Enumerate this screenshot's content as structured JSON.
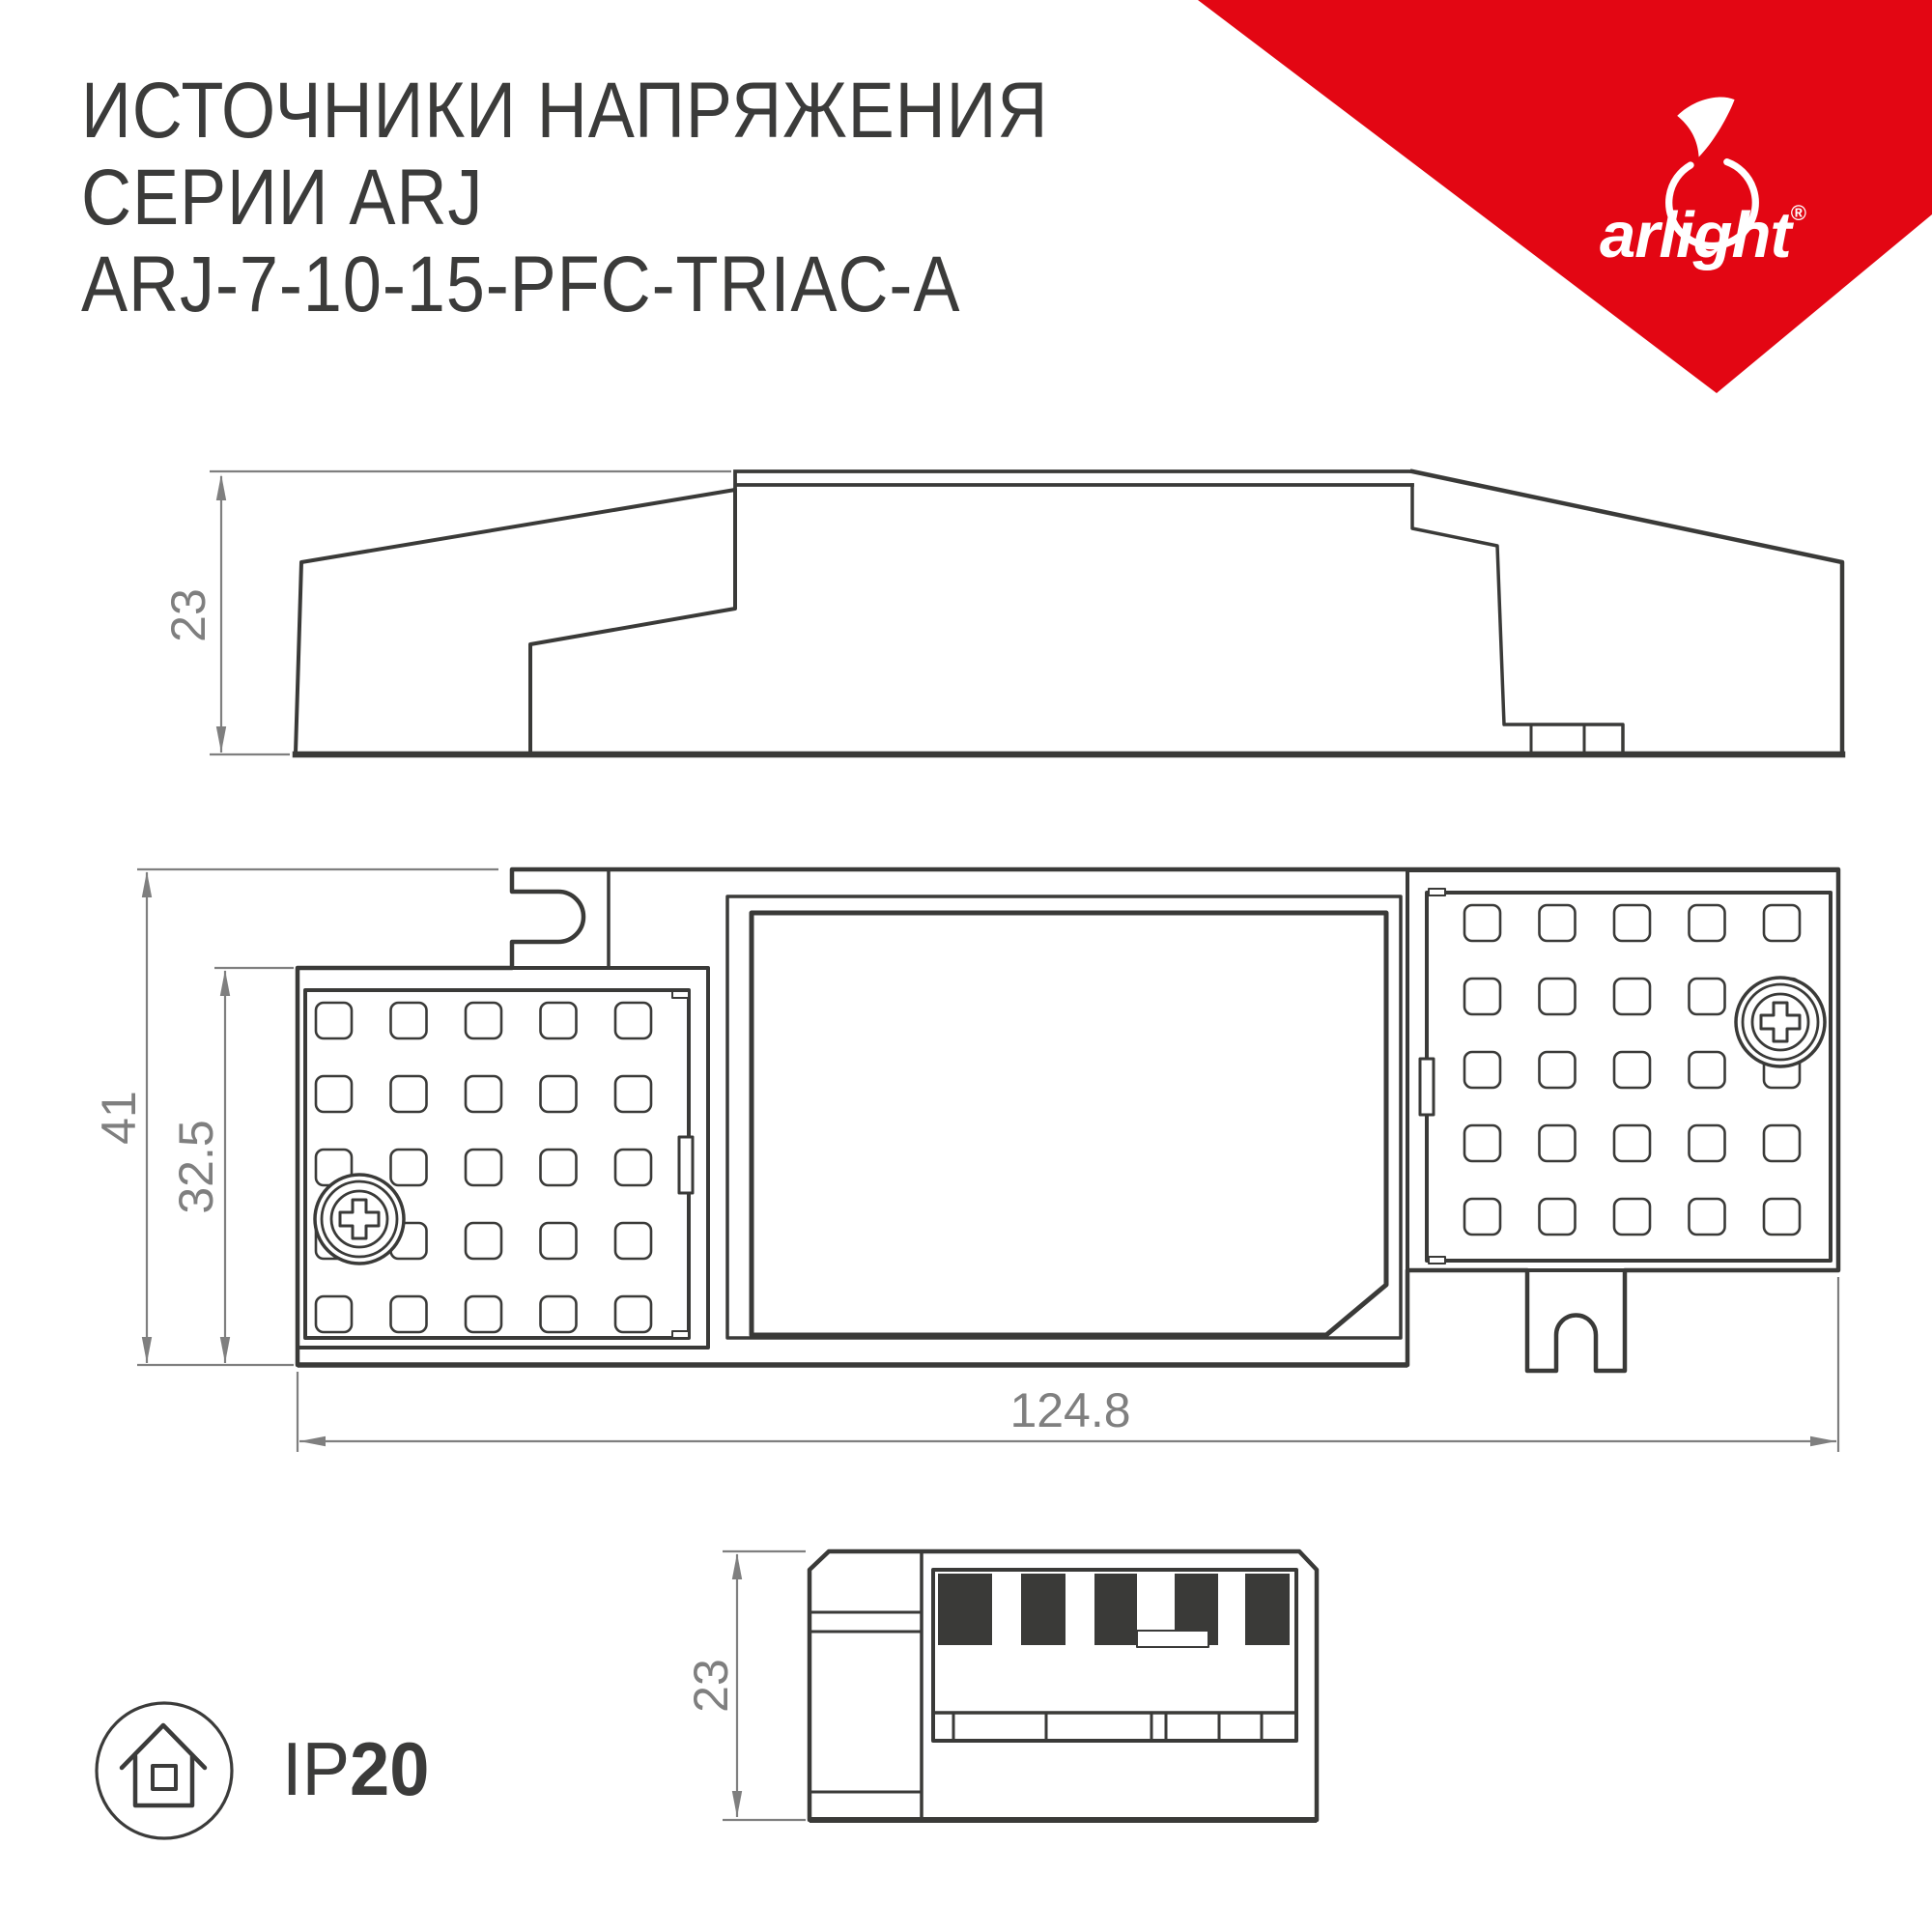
{
  "title": {
    "line1": "ИСТОЧНИКИ НАПРЯЖЕНИЯ",
    "line2": "СЕРИИ ARJ",
    "line3": "ARJ-7-10-15-PFC-TRIAC-A"
  },
  "brand": {
    "name": "arlight",
    "registered_mark": "®",
    "ribbon_color": "#e30613"
  },
  "dimensions": {
    "side_height": "23",
    "top_height": "41",
    "top_inner_height": "32.5",
    "length": "124.8",
    "end_height": "23"
  },
  "ip_badge": {
    "prefix": "IP",
    "value": "20"
  },
  "colors": {
    "line_dark": "#3a3a38",
    "dim_gray": "#7f7f7f",
    "text_dark": "#3b3b3a",
    "brand_red": "#e30613"
  }
}
